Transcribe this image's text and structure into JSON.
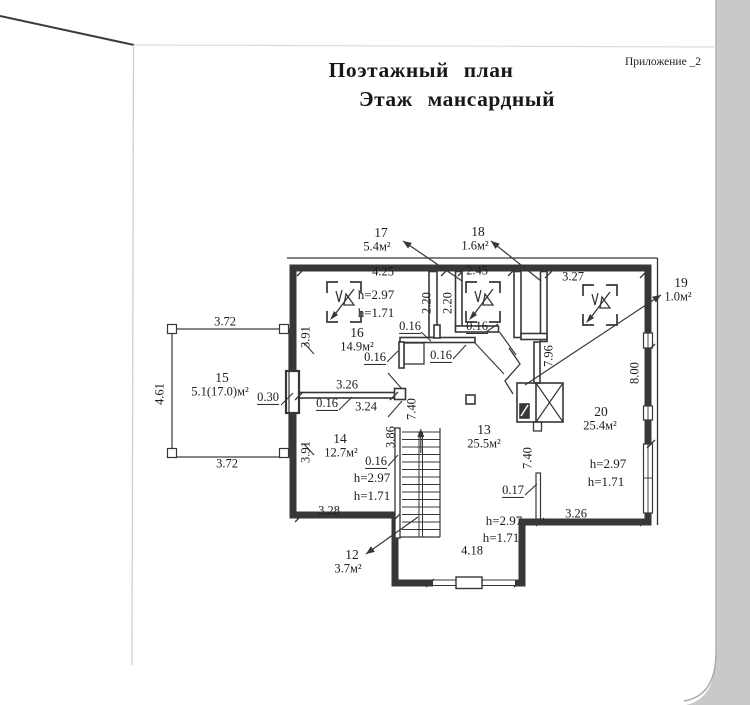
{
  "page": {
    "title_line1": "Поэтажный план",
    "title_line2": "Этаж мансардный",
    "annex_note": "Приложение _2",
    "line_color": "#373737",
    "scan_margin_color": "#c9c9c9"
  },
  "plan": {
    "rooms": [
      {
        "number": "12",
        "area": "3.7м²"
      },
      {
        "number": "13",
        "area": "25.5м²",
        "h_ceiling": "h=2.97",
        "h_knee": "h=1.71"
      },
      {
        "number": "14",
        "area": "12.7м²",
        "h_ceiling": "h=2.97",
        "h_knee": "h=1.71"
      },
      {
        "number": "15",
        "area": "5.1(17.0)м²"
      },
      {
        "number": "16",
        "area": "14.9м²",
        "h_ceiling": "h=2.97",
        "h_knee": "h=1.71"
      },
      {
        "number": "17",
        "area": "5.4м²"
      },
      {
        "number": "18",
        "area": "1.6м²"
      },
      {
        "number": "19",
        "area": "1.0м²"
      },
      {
        "number": "20",
        "area": "25.4м²",
        "h_ceiling": "h=2.97",
        "h_knee": "h=1.71"
      }
    ],
    "labels": [
      {
        "n": "room-17-number",
        "t": "17",
        "x": 381,
        "y": 233,
        "s": 13.5
      },
      {
        "n": "room-17-area",
        "t": "5.4м²",
        "x": 377,
        "y": 247
      },
      {
        "n": "room-18-number",
        "t": "18",
        "x": 478,
        "y": 232,
        "s": 13.5
      },
      {
        "n": "room-18-area",
        "t": "1.6м²",
        "x": 475,
        "y": 246
      },
      {
        "n": "room-19-number",
        "t": "19",
        "x": 681,
        "y": 283,
        "s": 13.5
      },
      {
        "n": "room-19-area",
        "t": "1.0м²",
        "x": 678,
        "y": 297
      },
      {
        "n": "room-16-number",
        "t": "16",
        "x": 357,
        "y": 333,
        "s": 13.5
      },
      {
        "n": "room-16-area",
        "t": "14.9м²",
        "x": 357,
        "y": 347
      },
      {
        "n": "room-15-number",
        "t": "15",
        "x": 222,
        "y": 378,
        "s": 13.5
      },
      {
        "n": "room-15-area",
        "t": "5.1(17.0)м²",
        "x": 220,
        "y": 392
      },
      {
        "n": "room-14-number",
        "t": "14",
        "x": 340,
        "y": 439,
        "s": 13.5
      },
      {
        "n": "room-14-area",
        "t": "12.7м²",
        "x": 341,
        "y": 453
      },
      {
        "n": "room-13-number",
        "t": "13",
        "x": 484,
        "y": 430,
        "s": 13.5
      },
      {
        "n": "room-13-area",
        "t": "25.5м²",
        "x": 484,
        "y": 444
      },
      {
        "n": "room-20-number",
        "t": "20",
        "x": 601,
        "y": 412,
        "s": 13.5
      },
      {
        "n": "room-20-area",
        "t": "25.4м²",
        "x": 600,
        "y": 426
      },
      {
        "n": "room-12-number",
        "t": "12",
        "x": 352,
        "y": 555,
        "s": 13.5
      },
      {
        "n": "room-12-area",
        "t": "3.7м²",
        "x": 348,
        "y": 569
      },
      {
        "n": "room-16-h-ceiling",
        "t": "h=2.97",
        "x": 376,
        "y": 295,
        "s": 13
      },
      {
        "n": "room-16-h-knee",
        "t": "h=1.71",
        "x": 376,
        "y": 313,
        "s": 13
      },
      {
        "n": "room-14-h-ceiling",
        "t": "h=2.97",
        "x": 372,
        "y": 478,
        "s": 13
      },
      {
        "n": "room-14-h-knee",
        "t": "h=1.71",
        "x": 372,
        "y": 496,
        "s": 13
      },
      {
        "n": "room-13-h-ceiling",
        "t": "h=2.97",
        "x": 504,
        "y": 521,
        "s": 13
      },
      {
        "n": "room-13-h-knee",
        "t": "h=1.71",
        "x": 501,
        "y": 538,
        "s": 13
      },
      {
        "n": "room-20-h-ceiling",
        "t": "h=2.97",
        "x": 608,
        "y": 464,
        "s": 13
      },
      {
        "n": "room-20-h-knee",
        "t": "h=1.71",
        "x": 606,
        "y": 482,
        "s": 13
      },
      {
        "n": "dim-4-25",
        "t": "4.25",
        "x": 383,
        "y": 272
      },
      {
        "n": "dim-2-45",
        "t": "2.45",
        "x": 477,
        "y": 271
      },
      {
        "n": "dim-3-27",
        "t": "3.27",
        "x": 573,
        "y": 277
      },
      {
        "n": "dim-3-72-top",
        "t": "3.72",
        "x": 225,
        "y": 322
      },
      {
        "n": "dim-3-72-bottom",
        "t": "3.72",
        "x": 227,
        "y": 464
      },
      {
        "n": "dim-0-30",
        "t": "0.30",
        "x": 268,
        "y": 398,
        "u": 1
      },
      {
        "n": "dim-3-26-mid",
        "t": "3.26",
        "x": 347,
        "y": 385
      },
      {
        "n": "dim-0-16-partition",
        "t": "0.16",
        "x": 327,
        "y": 404,
        "u": 1
      },
      {
        "n": "dim-3-24",
        "t": "3.24",
        "x": 366,
        "y": 407
      },
      {
        "n": "dim-0-16-a",
        "t": "0.16",
        "x": 410,
        "y": 327,
        "u": 1
      },
      {
        "n": "dim-0-16-b",
        "t": "0.16",
        "x": 477,
        "y": 327,
        "u": 1
      },
      {
        "n": "dim-0-16-c",
        "t": "0.16",
        "x": 441,
        "y": 356,
        "u": 1
      },
      {
        "n": "dim-0-16-d",
        "t": "0.16",
        "x": 375,
        "y": 358,
        "u": 1
      },
      {
        "n": "dim-0-16-stair",
        "t": "0.16",
        "x": 376,
        "y": 462,
        "u": 1
      },
      {
        "n": "dim-0-17",
        "t": "0.17",
        "x": 513,
        "y": 491,
        "u": 1
      },
      {
        "n": "dim-3-28",
        "t": "3.28",
        "x": 329,
        "y": 511
      },
      {
        "n": "dim-4-18",
        "t": "4.18",
        "x": 472,
        "y": 551
      },
      {
        "n": "dim-3-26-bottom",
        "t": "3.26",
        "x": 576,
        "y": 514
      },
      {
        "n": "dim-3-91-top",
        "t": "3.91",
        "x": 306,
        "y": 337,
        "r": 1
      },
      {
        "n": "dim-3-91-bottom",
        "t": "3.91",
        "x": 306,
        "y": 452,
        "r": 1
      },
      {
        "n": "dim-4-61",
        "t": "4.61",
        "x": 160,
        "y": 394,
        "r": 1
      },
      {
        "n": "dim-2-20-a",
        "t": "2.20",
        "x": 427,
        "y": 303,
        "r": 1
      },
      {
        "n": "dim-2-20-b",
        "t": "2.20",
        "x": 448,
        "y": 303,
        "r": 1
      },
      {
        "n": "dim-7-96",
        "t": "7.96",
        "x": 549,
        "y": 356,
        "r": 1
      },
      {
        "n": "dim-8-00",
        "t": "8.00",
        "x": 635,
        "y": 373,
        "r": 1
      },
      {
        "n": "dim-7-40-center",
        "t": "7.40",
        "x": 412,
        "y": 409,
        "r": 1
      },
      {
        "n": "dim-7-40-right",
        "t": "7.40",
        "x": 528,
        "y": 458,
        "r": 1
      },
      {
        "n": "dim-3-86",
        "t": "3.86",
        "x": 391,
        "y": 437,
        "r": 1
      }
    ]
  }
}
